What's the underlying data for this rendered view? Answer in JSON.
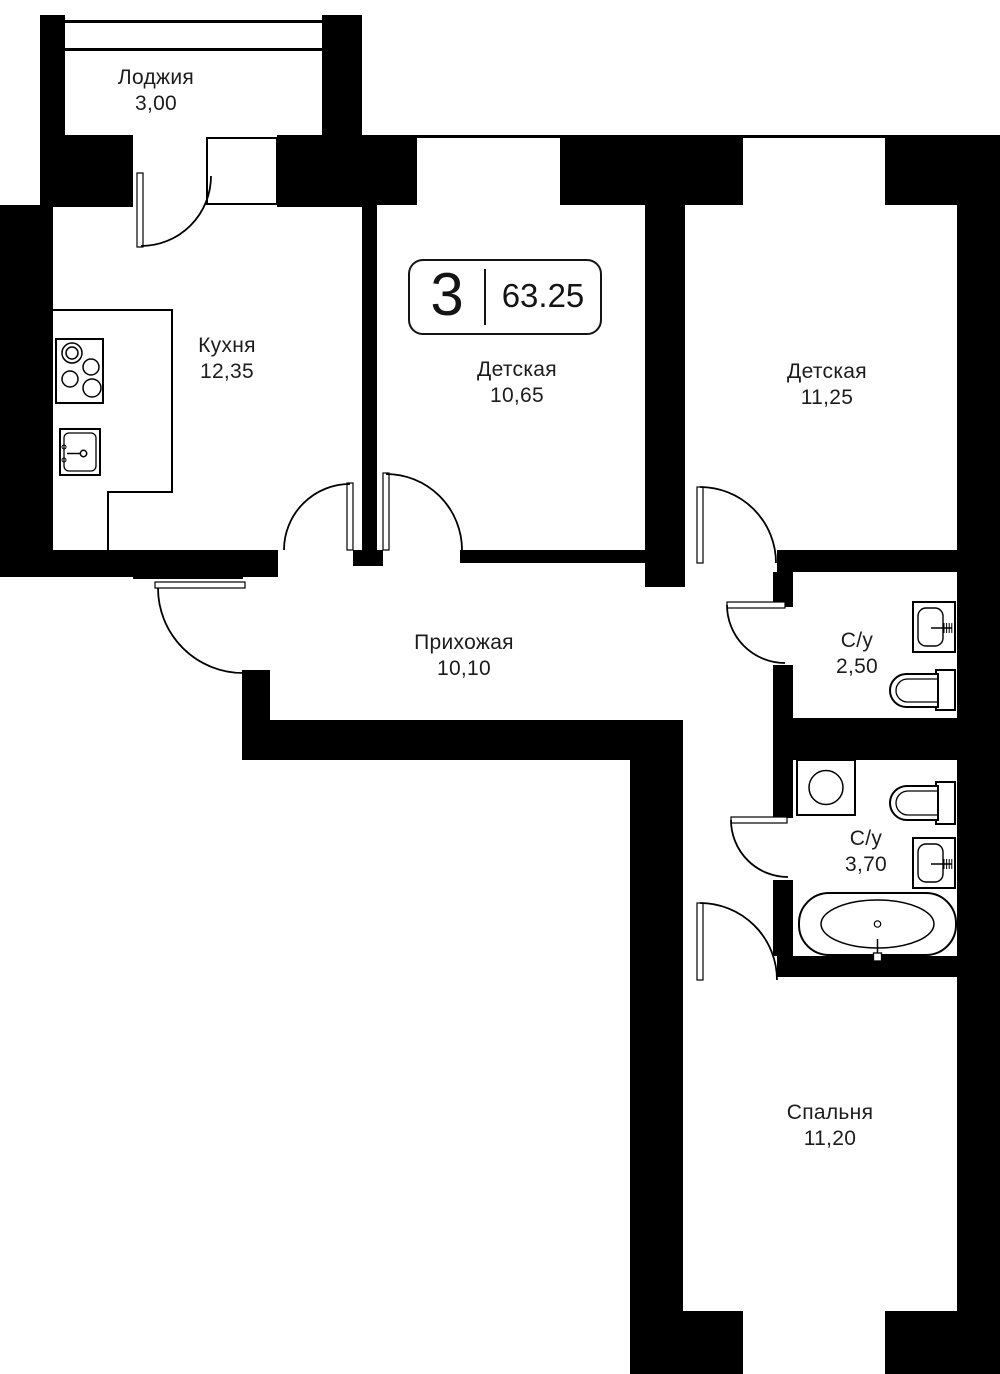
{
  "plan": {
    "width": 1000,
    "height": 1374,
    "colors": {
      "wall": "#000000",
      "bg": "#ffffff",
      "line": "#000000",
      "text": "#1c1c1c"
    },
    "badge": {
      "rooms": "3",
      "area": "63.25",
      "x": 408,
      "y": 259,
      "w": 194,
      "h": 76
    },
    "rooms": [
      {
        "id": "loggia",
        "name": "Лоджия",
        "area": "3,00",
        "x": 156,
        "y": 91
      },
      {
        "id": "kitchen",
        "name": "Кухня",
        "area": "12,35",
        "x": 227,
        "y": 359
      },
      {
        "id": "nursery-1",
        "name": "Детская",
        "area": "10,65",
        "x": 517,
        "y": 383
      },
      {
        "id": "nursery-2",
        "name": "Детская",
        "area": "11,25",
        "x": 827,
        "y": 385
      },
      {
        "id": "hallway",
        "name": "Прихожая",
        "area": "10,10",
        "x": 464,
        "y": 656
      },
      {
        "id": "bathroom-1",
        "name": "С/у",
        "area": "2,50",
        "x": 857,
        "y": 654
      },
      {
        "id": "bathroom-2",
        "name": "С/у",
        "area": "3,70",
        "x": 866,
        "y": 852
      },
      {
        "id": "bedroom",
        "name": "Спальня",
        "area": "11,20",
        "x": 830,
        "y": 1126
      }
    ],
    "walls": [
      [
        40,
        15,
        25,
        192
      ],
      [
        322,
        15,
        40,
        192
      ],
      [
        65,
        135,
        68,
        72
      ],
      [
        277,
        135,
        45,
        72
      ],
      [
        362,
        135,
        55,
        70
      ],
      [
        560,
        135,
        183,
        70
      ],
      [
        885,
        135,
        115,
        70
      ],
      [
        0,
        205,
        53,
        372
      ],
      [
        0,
        550,
        278,
        27
      ],
      [
        133,
        573,
        110,
        6
      ],
      [
        362,
        205,
        15,
        345
      ],
      [
        353,
        550,
        30,
        16
      ],
      [
        460,
        550,
        185,
        13
      ],
      [
        645,
        205,
        40,
        382
      ],
      [
        777,
        550,
        180,
        22
      ],
      [
        957,
        205,
        43,
        1169
      ],
      [
        773,
        572,
        20,
        35
      ],
      [
        773,
        665,
        20,
        53
      ],
      [
        270,
        720,
        413,
        40
      ],
      [
        773,
        718,
        184,
        42
      ],
      [
        242,
        670,
        28,
        90
      ],
      [
        630,
        760,
        53,
        614
      ],
      [
        773,
        760,
        20,
        58
      ],
      [
        773,
        880,
        20,
        76
      ],
      [
        777,
        956,
        183,
        21
      ],
      [
        630,
        1311,
        113,
        63
      ],
      [
        885,
        1311,
        115,
        63
      ]
    ],
    "lines": [
      [
        65,
        20,
        257,
        3
      ],
      [
        65,
        48,
        257,
        3
      ],
      [
        362,
        135,
        638,
        3
      ],
      [
        53,
        309,
        120,
        2
      ],
      [
        171,
        309,
        2,
        184
      ],
      [
        108,
        491,
        65,
        2
      ],
      [
        107,
        491,
        2,
        86
      ]
    ],
    "window_frames": [
      [
        207,
        138,
        70,
        66
      ]
    ],
    "doors": [
      {
        "id": "balcony-door",
        "leaf": [
          137,
          173,
          6,
          74
        ],
        "arc": "M 141 246 A 70 70 0 0 0 211 176"
      },
      {
        "id": "entrance-door",
        "leaf": [
          155,
          582,
          90,
          6
        ],
        "arc": "M 158 588 A 85 85 0 0 0 243 673"
      },
      {
        "id": "kitchen-door",
        "leaf": [
          347,
          483,
          6,
          67
        ],
        "arc": "M 350 484 A 66 66 0 0 0 284 550"
      },
      {
        "id": "nursery-1-door",
        "leaf": [
          383,
          473,
          6,
          77
        ],
        "arc": "M 386 474 A 76 76 0 0 1 462 550"
      },
      {
        "id": "nursery-2-door",
        "leaf": [
          697,
          487,
          6,
          76
        ],
        "arc": "M 700 487 A 76 76 0 0 1 776 563"
      },
      {
        "id": "bathroom-1-door",
        "leaf": [
          727,
          602,
          58,
          6
        ],
        "arc": "M 727 605 A 58 58 0 0 0 785 663"
      },
      {
        "id": "bathroom-2-door",
        "leaf": [
          731,
          817,
          56,
          6
        ],
        "arc": "M 731 820 A 57 57 0 0 0 788 877"
      },
      {
        "id": "bedroom-door",
        "leaf": [
          697,
          903,
          6,
          77
        ],
        "arc": "M 700 903 A 77 77 0 0 1 777 980"
      }
    ],
    "fixtures": [
      {
        "id": "stove-icon",
        "type": "stove",
        "x": 56,
        "y": 339,
        "w": 47,
        "h": 64,
        "burners": [
          [
            72,
            353,
            10
          ],
          [
            72,
            353,
            6
          ],
          [
            70,
            379,
            8
          ],
          [
            91,
            367,
            8
          ],
          [
            92,
            388,
            9
          ]
        ]
      },
      {
        "id": "kitchen-sink-icon",
        "type": "ksink",
        "x": 60,
        "y": 429,
        "w": 40,
        "h": 46
      },
      {
        "id": "washbasin-1-icon",
        "type": "basin",
        "x": 913,
        "y": 602,
        "w": 42,
        "h": 50,
        "ty": 628
      },
      {
        "id": "toilet-1-icon",
        "type": "toilet",
        "bowl": [
          890,
          674,
          48,
          33
        ],
        "tank": [
          936,
          670,
          19,
          40
        ]
      },
      {
        "id": "washing-machine-icon",
        "type": "washer",
        "x": 797,
        "y": 760,
        "w": 58,
        "h": 55
      },
      {
        "id": "toilet-2-icon",
        "type": "toilet",
        "bowl": [
          890,
          786,
          48,
          34
        ],
        "tank": [
          936,
          782,
          19,
          42
        ]
      },
      {
        "id": "washbasin-2-icon",
        "type": "basin",
        "x": 913,
        "y": 838,
        "w": 42,
        "h": 50,
        "ty": 864
      },
      {
        "id": "bathtub-icon",
        "type": "bathtub",
        "x": 799,
        "y": 893,
        "w": 157,
        "h": 62
      }
    ]
  }
}
